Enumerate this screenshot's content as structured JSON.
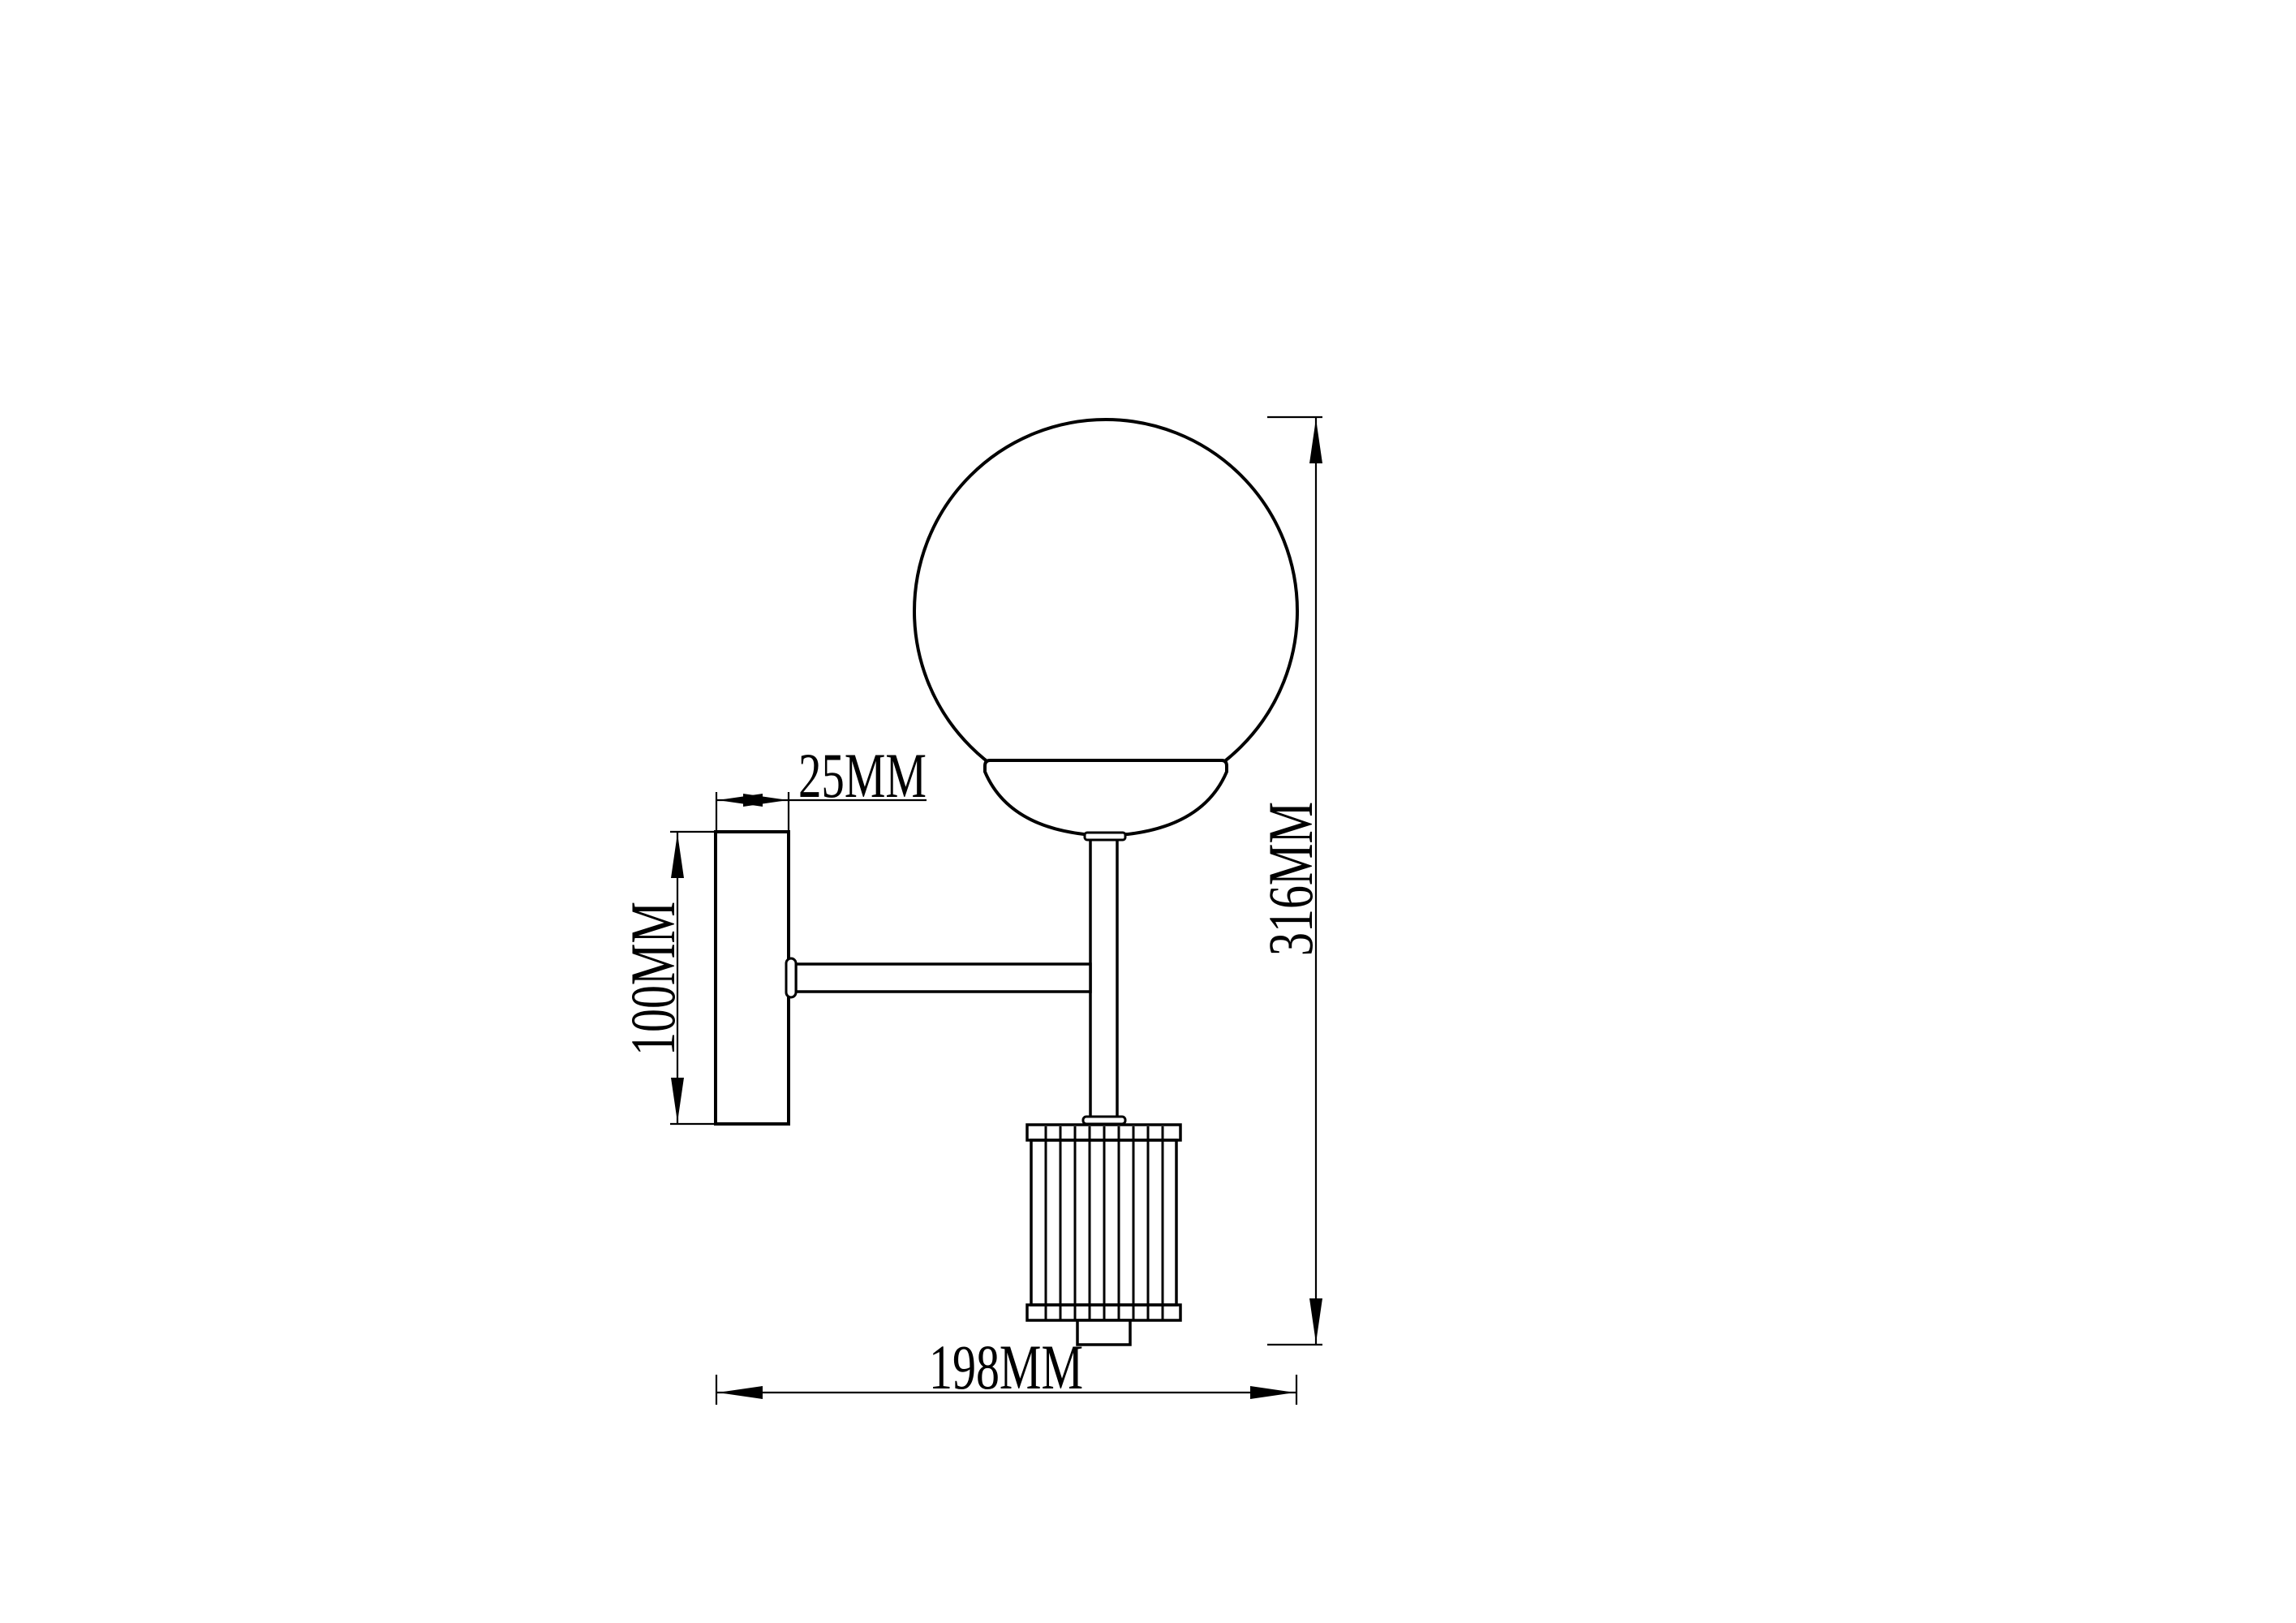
{
  "page": {
    "background_color": "#ffffff",
    "line_color": "#000000"
  },
  "drawing": {
    "type": "technical-dimension-drawing",
    "subject": "wall sconce side elevation",
    "unit": "MM",
    "labels": {
      "plate_depth": "25MM",
      "plate_height": "100MM",
      "overall_height": "316MM",
      "overall_depth": "198MM"
    }
  }
}
